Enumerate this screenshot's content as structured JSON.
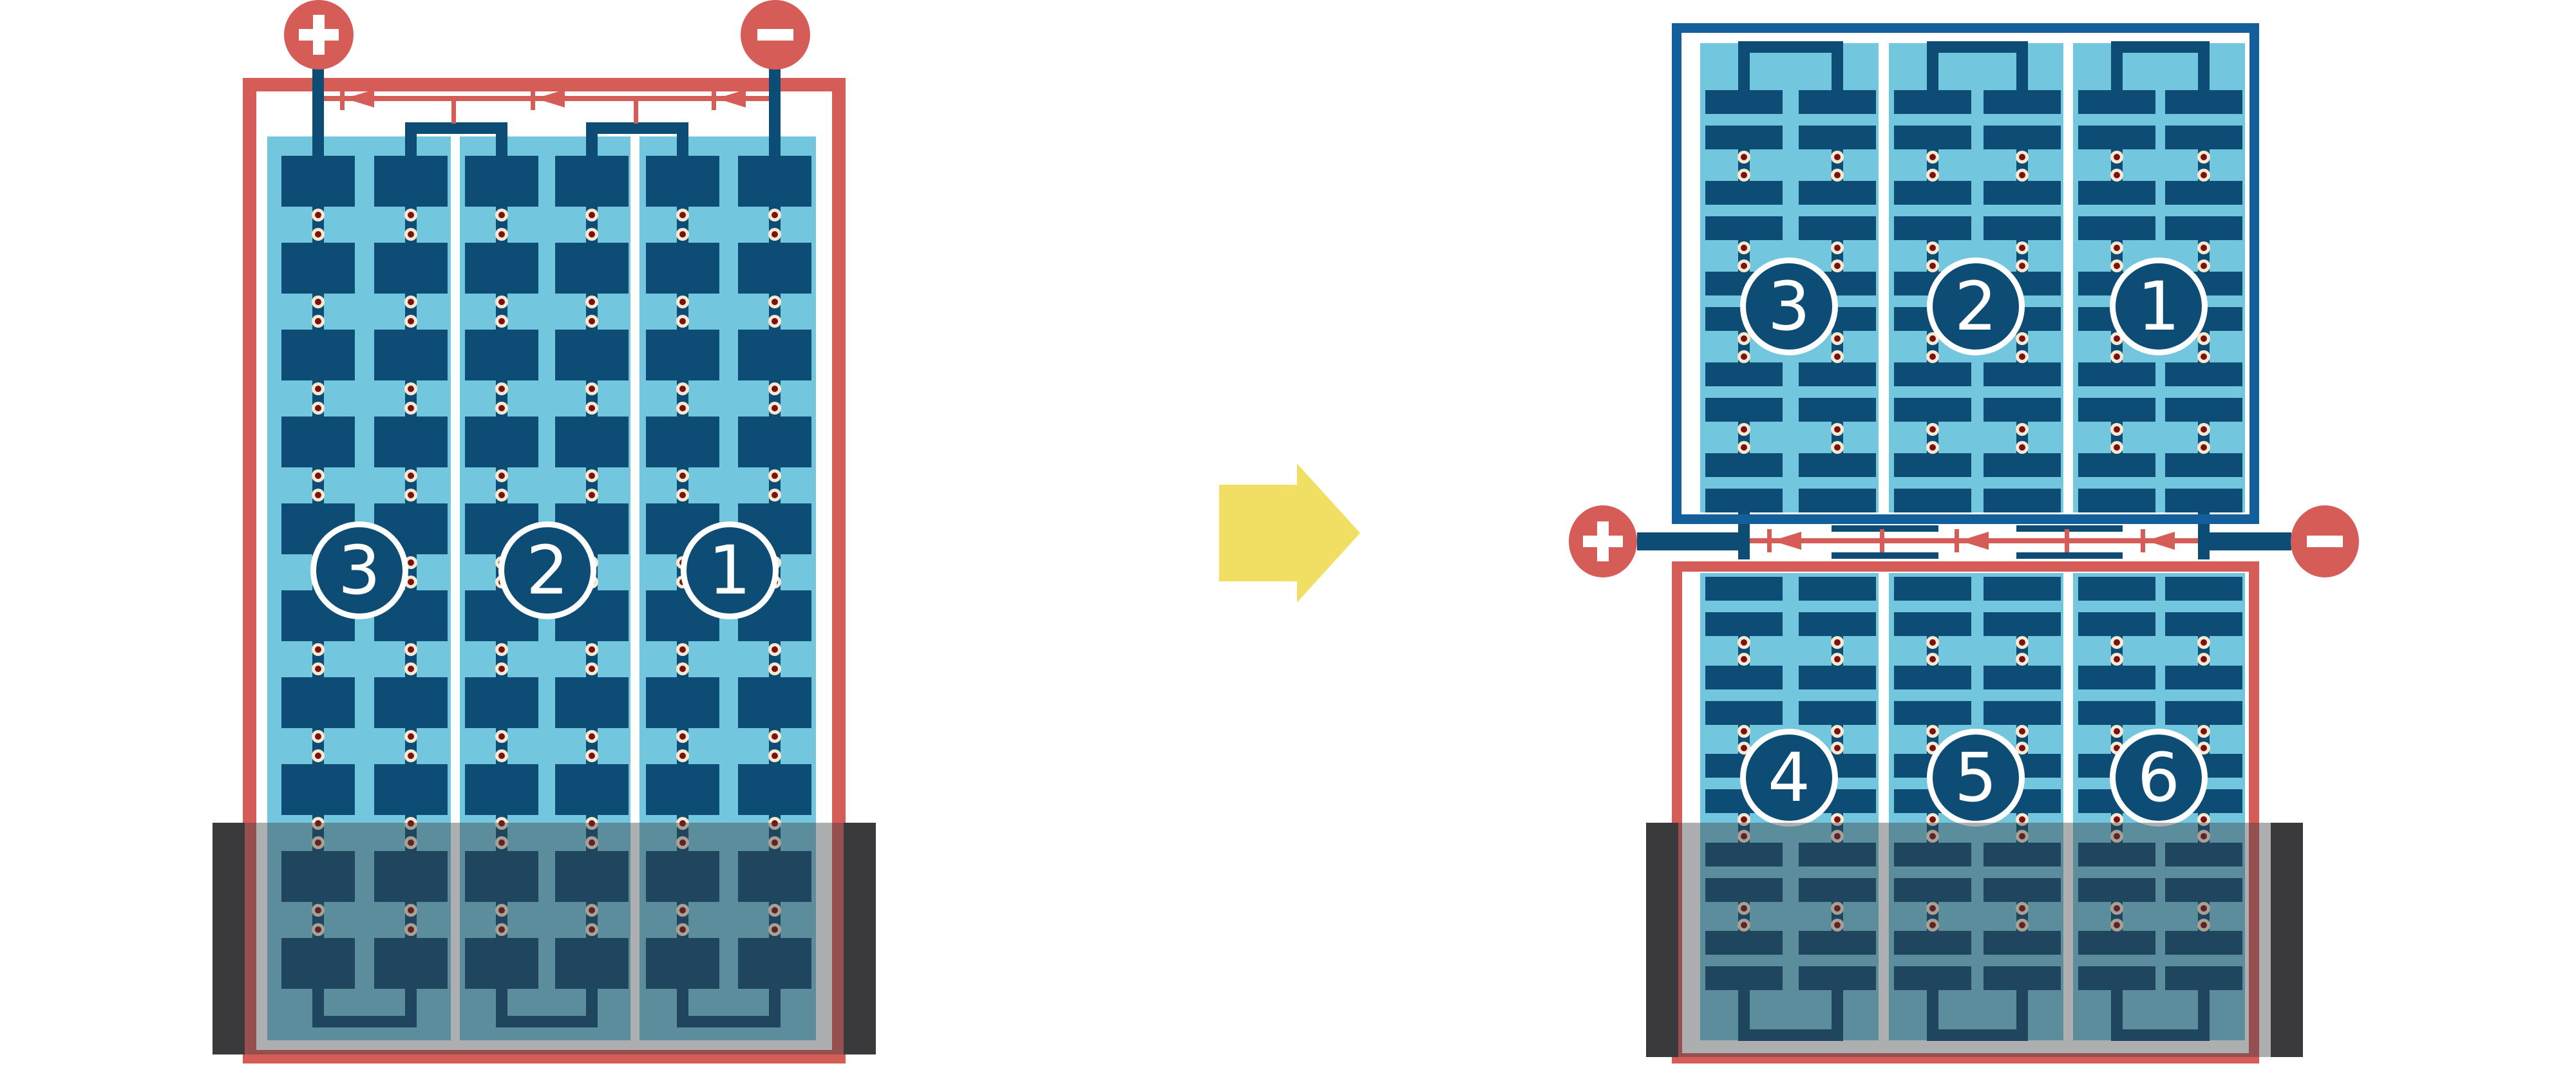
{
  "left_battery": {
    "positive_terminal_label": "+",
    "negative_terminal_label": "−",
    "cell_numbers": [
      "3",
      "2",
      "1"
    ]
  },
  "right_battery": {
    "positive_terminal_label": "+",
    "negative_terminal_label": "−",
    "top_unit_cell_numbers": [
      "3",
      "2",
      "1"
    ],
    "bottom_unit_cell_numbers": [
      "4",
      "5",
      "6"
    ]
  },
  "colors": {
    "wire_red": "#d65c57",
    "plate_dark_blue": "#0d4c74",
    "unit_frame_blue": "#135f9c",
    "electrolyte_light_blue": "#72c7de",
    "link_cream": "#f6e9d1",
    "link_dark_red": "#7d1111",
    "arrow_yellow": "#f1df63",
    "case_dark_gray": "#3a3a3c",
    "case_overlay_gray": "rgba(60,62,66,0.42)",
    "background_white": "#ffffff",
    "number_text_white": "#ffffff"
  }
}
